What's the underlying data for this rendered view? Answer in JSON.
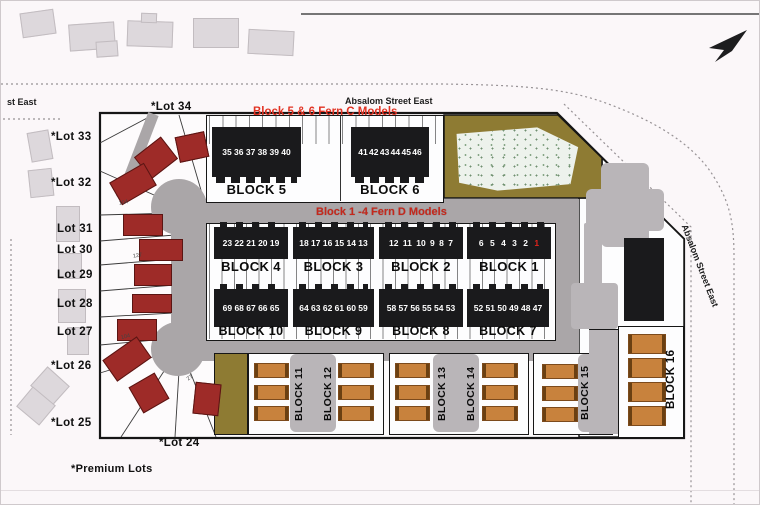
{
  "streets": {
    "top": "Absalom Street East",
    "left_partial": "st East",
    "right": "Absalom Street East"
  },
  "annotations": {
    "fern_c": "Block 5 & 6 Fern C Models",
    "fern_d": "Block 1 -4 Fern D Models",
    "premium": "*Premium Lots"
  },
  "lots": [
    {
      "label": "*Lot 34"
    },
    {
      "label": "*Lot 33"
    },
    {
      "label": "*Lot 32"
    },
    {
      "label": "Lot 31"
    },
    {
      "label": "Lot 30"
    },
    {
      "label": "Lot 29"
    },
    {
      "label": "Lot 28"
    },
    {
      "label": "Lot 27"
    },
    {
      "label": "*Lot 26"
    },
    {
      "label": "*Lot 25"
    },
    {
      "label": "*Lot 24"
    }
  ],
  "blocks": {
    "b5": {
      "label": "BLOCK 5",
      "units": "35 36 37 38 39 40"
    },
    "b6": {
      "label": "BLOCK 6",
      "units": "41 42 43 44 45 46"
    },
    "b4": {
      "label": "BLOCK 4",
      "units": "23 22 21 20 19"
    },
    "b3": {
      "label": "BLOCK 3",
      "units": "18 17 16 15 14 13"
    },
    "b2": {
      "label": "BLOCK 2",
      "units": "12 11 10 9 8 7"
    },
    "b1": {
      "label": "BLOCK 1",
      "units": "6 5 4 3 2",
      "unit_red": "1"
    },
    "b10": {
      "label": "BLOCK 10",
      "units": "69 68 67 66 65"
    },
    "b9": {
      "label": "BLOCK 9",
      "units": "64 63 62 61 60 59"
    },
    "b8": {
      "label": "BLOCK 8",
      "units": "58 57 56 55 54 53"
    },
    "b7": {
      "label": "BLOCK 7",
      "units": "52 51 50 49 48 47"
    },
    "b11": {
      "label": "BLOCK 11"
    },
    "b12": {
      "label": "BLOCK 12"
    },
    "b13": {
      "label": "BLOCK 13"
    },
    "b14": {
      "label": "BLOCK 14"
    },
    "b15": {
      "label": "BLOCK 15"
    },
    "b16": {
      "label": "BLOCK 16"
    }
  },
  "measurements": [
    "104",
    "127",
    "104",
    "27"
  ],
  "colors": {
    "road": "#aaa6a8",
    "olive": "#8e7b33",
    "red_house": "#9e2b28",
    "orange_building": "#c8823d",
    "black_building": "#1a1a1c",
    "annotation_red": "#e23222"
  }
}
